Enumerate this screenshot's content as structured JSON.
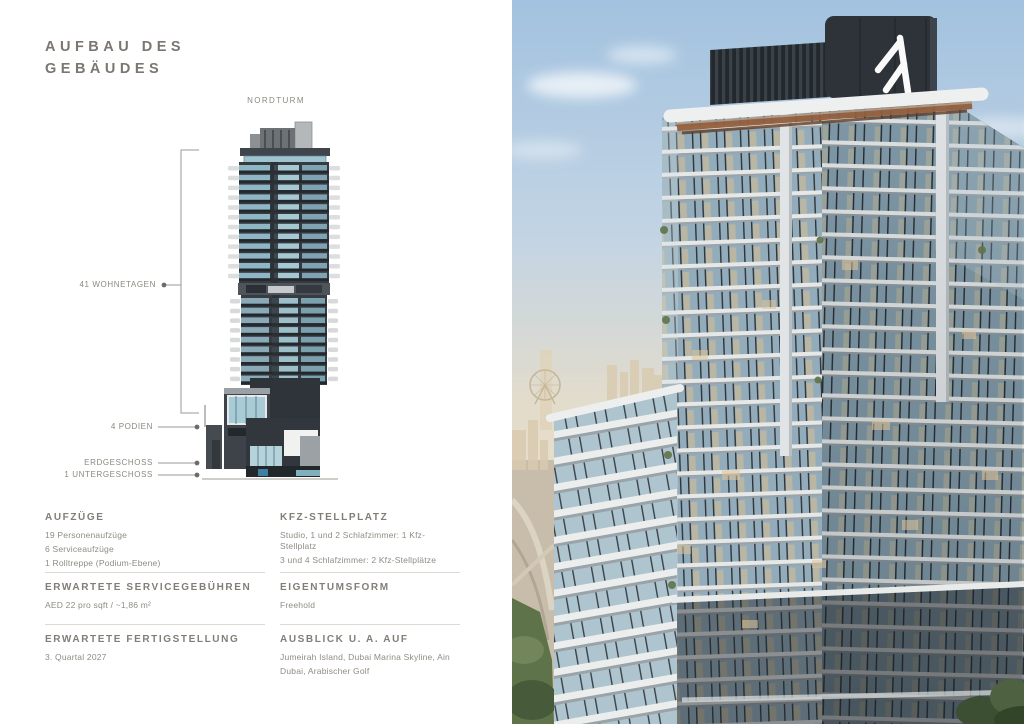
{
  "page": {
    "title_line1": "AUFBAU DES",
    "title_line2": "GEBÄUDES"
  },
  "diagram": {
    "tower_label": "NORDTURM",
    "annotations": [
      {
        "label": "41 WOHNETAGEN"
      },
      {
        "label": "4 PODIEN"
      },
      {
        "label": "ERDGESCHOSS"
      },
      {
        "label": "1 UNTERGESCHOSS"
      }
    ]
  },
  "sections": [
    {
      "heading": "AUFZÜGE",
      "lines": [
        "19 Personenaufzüge",
        "6 Serviceaufzüge",
        "1 Rolltreppe (Podium-Ebene)"
      ]
    },
    {
      "heading": "KFZ-STELLPLATZ",
      "lines": [
        "Studio, 1 und 2 Schlafzimmer: 1 Kfz-Stellplatz",
        "3 und 4 Schlafzimmer: 2 Kfz-Stellplätze"
      ]
    },
    {
      "heading": "ERWARTETE SERVICEGEBÜHREN",
      "lines": [
        "AED 22 pro sqft / ~1,86 m²"
      ]
    },
    {
      "heading": "EIGENTUMSFORM",
      "lines": [
        "Freehold"
      ]
    },
    {
      "heading": "ERWARTETE FERTIGSTELLUNG",
      "lines": [
        "3. Quartal 2027"
      ]
    },
    {
      "heading": "AUSBLICK U. A. AUF",
      "lines": [
        "Jumeirah Island, Dubai Marina Skyline, Ain",
        "Dubai, Arabischer Golf"
      ]
    }
  ],
  "colors": {
    "text": "#7b7770",
    "body_text": "#908c84",
    "divider": "#dcdad4",
    "diagram_charcoal": "#343a40",
    "diagram_glass": "#9fc3cf",
    "photo_sky": "#a2c2df",
    "photo_haze": "#eadfc9",
    "photo_copper": "#935f3c",
    "photo_greenery": "#5e7349",
    "logo_color": "#fafafa"
  }
}
